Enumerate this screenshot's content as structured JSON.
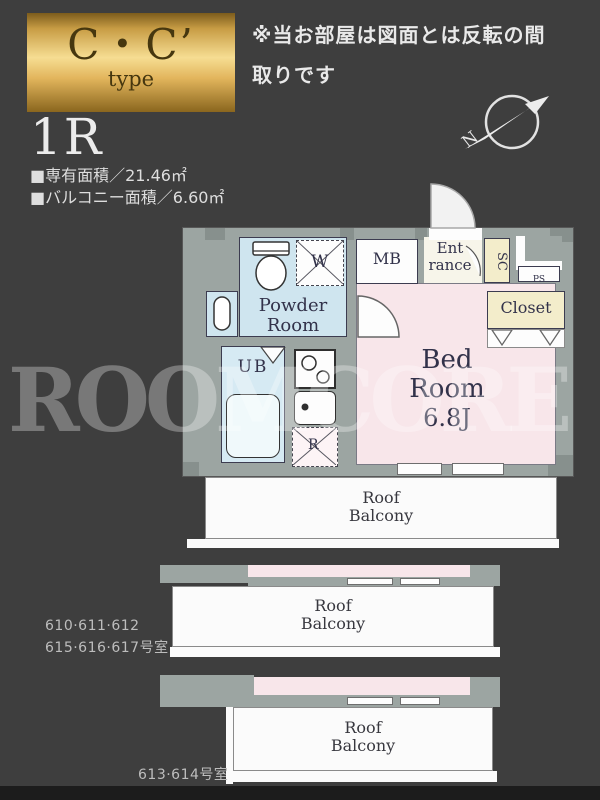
{
  "header": {
    "badge_title": "C・C’",
    "badge_subtitle": "type",
    "plan_type": "1R",
    "area_line1": "■専有面積／21.46㎡",
    "area_line2": "■バルコニー面積／6.60㎡",
    "note_line1": "※当お部屋は図面とは反転の間",
    "note_line2": "取りです",
    "compass_n": "N"
  },
  "plan": {
    "labels": {
      "powder_line1": "Powder",
      "powder_line2": "Room",
      "ub": "UB",
      "mb": "MB",
      "entrance_line1": "Ent",
      "entrance_line2": "rance",
      "sc": "SC",
      "ps": "PS",
      "closet": "Closet",
      "bed_line1": "Bed",
      "bed_line2": "Room",
      "bed_size": "6.8J",
      "washer": "W",
      "fridge": "R"
    },
    "balcony": {
      "line1": "Roof",
      "line2": "Balcony"
    }
  },
  "footer": {
    "units_upper_line1": "610·611·612",
    "units_upper_line2": "615·616·617号室",
    "units_lower": "613·614号室"
  },
  "watermark": "ROOMCORE",
  "colors": {
    "background": "#3e3e3e",
    "wall_gray": "#9ca5a2",
    "bedroom_pink": "#f8e6ea",
    "wet_area_blue": "#cfe5ef",
    "closet_yellow": "#f3edcb",
    "badge_gold": "#e9c97a",
    "balcony_white": "#fbfbfb"
  }
}
